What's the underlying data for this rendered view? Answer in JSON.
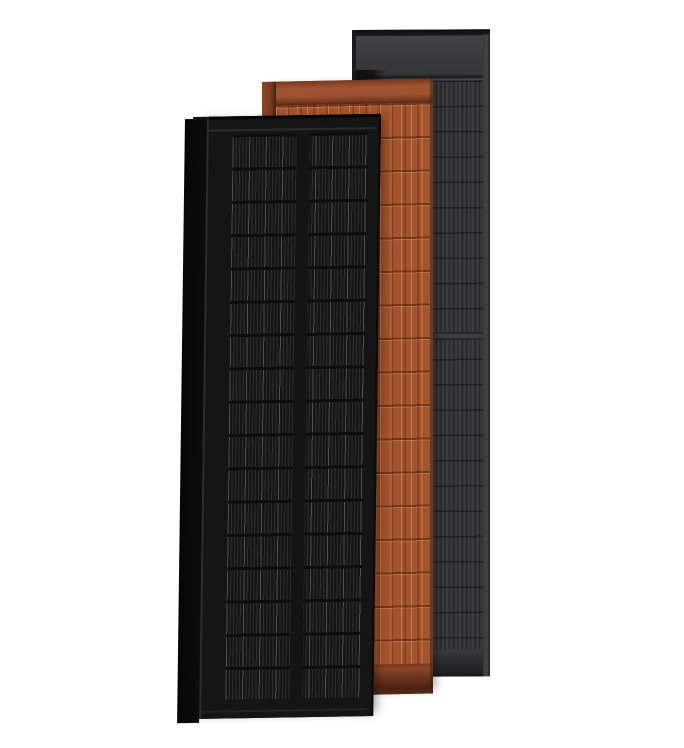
{
  "scene": {
    "description": "Product render of three overlapping portrait solar panels on a white background",
    "background_color": "#ffffff",
    "panels": [
      {
        "id": "black",
        "label": "Black solar panel",
        "position": "front-left",
        "frame_color": "#131313",
        "cell_color": "#161616",
        "busbar_color": "#3a3a3a",
        "cell_columns": 2,
        "cell_rows": 17
      },
      {
        "id": "terracotta",
        "label": "Terracotta solar panel",
        "position": "middle",
        "frame_color": "#93502c",
        "cell_color": "#a3532d",
        "busbar_color": "#b4673c",
        "cell_rows": 17
      },
      {
        "id": "anthracite",
        "label": "Anthracite solar panel",
        "position": "back-right",
        "frame_color": "#2d2d2f",
        "cell_color": "#3c3c3e",
        "header_color": "#3e3e40",
        "cell_rows": 22
      }
    ]
  }
}
